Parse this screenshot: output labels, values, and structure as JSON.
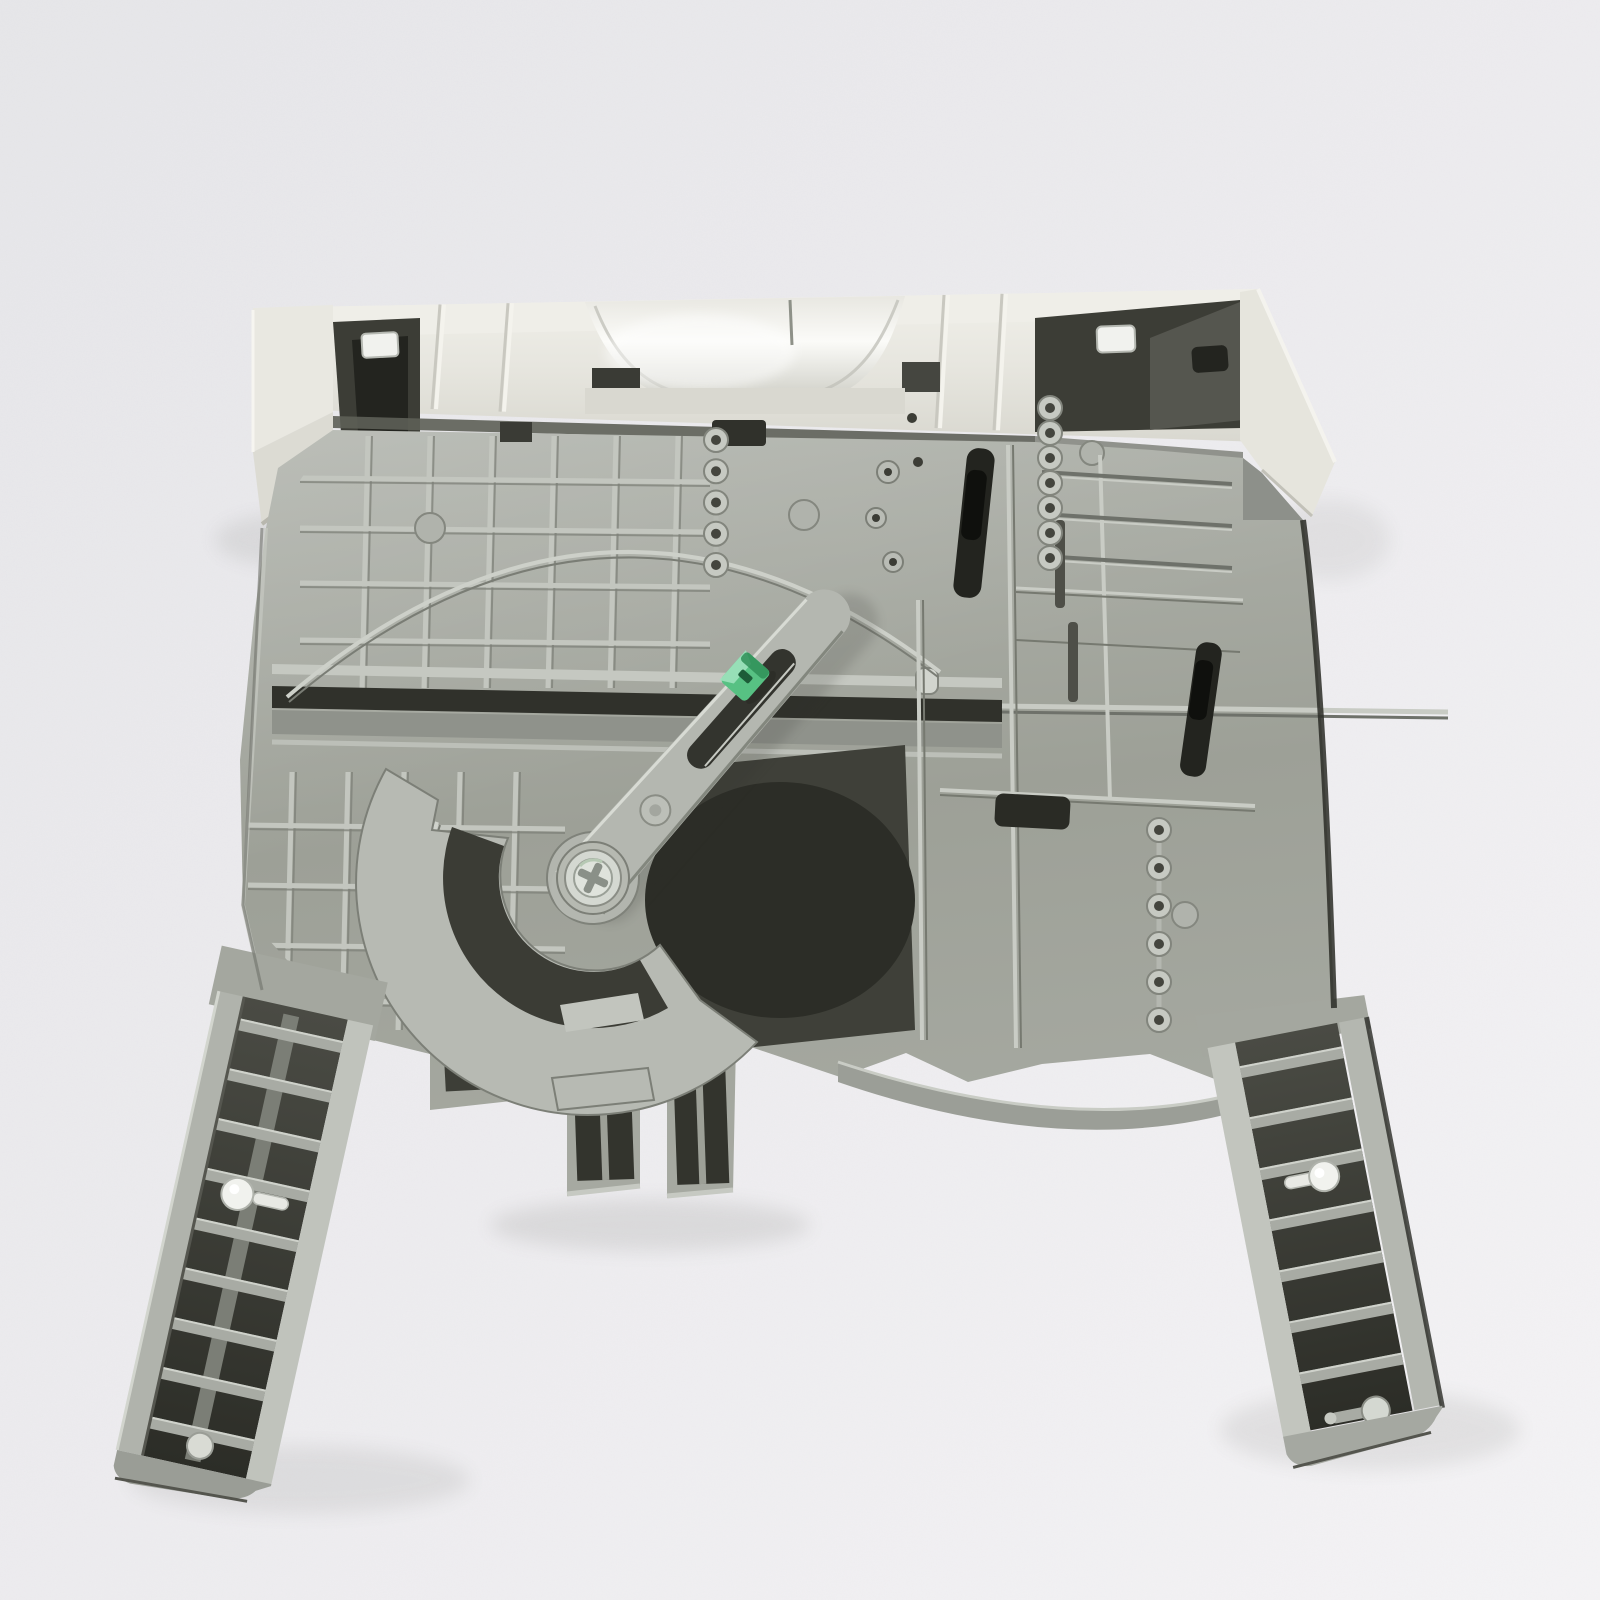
{
  "meta": {
    "type": "product photograph",
    "subject": "Printer paper cassette tray shown from the underside, tilted with its ivory front bezel at top and two telescoping slide rails extending toward the viewer",
    "background": "plain light-gray textured paper backdrop",
    "visible_text": ""
  },
  "colors": {
    "background": "#ebeaed",
    "background_bright": "#f4f3f5",
    "tray_gray": "#a6a9a1",
    "tray_gray_light": "#c3c6bf",
    "tray_gray_dark": "#7e8179",
    "panel_shadow": "#8f928b",
    "cavity_dark": "#3c3d36",
    "cavity_black": "#23241f",
    "bezel_ivory": "#e9e8e1",
    "bezel_ivory_light": "#f4f3ed",
    "bezel_ivory_shadow": "#c9c8c0",
    "green_clip": "#57c183",
    "green_clip_dark": "#2f8f58",
    "green_clip_light": "#9fe2bd",
    "roller_white": "#f1f2ee",
    "metal_silver": "#d4d8d1",
    "edge_dark": "#2a2b26"
  },
  "parts": {
    "tray": "printer paper tray underside",
    "bezel": "ivory front bezel with recessed handle scoop",
    "handle_scoop": "curved hand recess in bezel",
    "left_rail": "left slide rail with ladder ribs and white roller",
    "right_rail": "right slide rail with ladder ribs, white roller and metal pin",
    "cam": "rotating paper-length cam sector",
    "arm": "slotted adjustment swing arm",
    "green_clip": "green adjustment clip on arm slot",
    "screw": "silver pivot screw at cam center",
    "channel": "long dark guide channel across tray",
    "arc_guide": "thin arc-shaped guide ridge",
    "donut_chains": "rows of small ring-shaped bosses",
    "boxes": "open rib boxes along bottom edge",
    "latches": "small white latch tabs in dark bezel cavities"
  },
  "decor": {
    "donut_chains": [
      {
        "x": 716,
        "y1": 440,
        "y2": 565,
        "count": 5
      },
      {
        "x": 685,
        "y1": 837,
        "y2": 1005,
        "count": 6
      },
      {
        "x": 1050,
        "y1": 408,
        "y2": 558,
        "count": 7
      },
      {
        "x": 1159,
        "y1": 830,
        "y2": 1020,
        "count": 6
      }
    ],
    "left_rail": {
      "count": 9,
      "x": -52,
      "width": 106,
      "y0": 22,
      "dy": 51,
      "h": 12
    },
    "right_rail": {
      "count": 7,
      "x": -56,
      "width": 104,
      "y0": 24,
      "dy": 52,
      "h": 12
    },
    "grid_upper": {
      "verticals": [
        368,
        430,
        492,
        554,
        616,
        678
      ],
      "horizontals": [
        478,
        528,
        583,
        640
      ],
      "x1": 300,
      "x2": 710,
      "y1": 436,
      "y2": 688
    },
    "grid_lower": {
      "verticals": [
        292,
        348,
        404,
        460,
        516
      ],
      "horizontals": [
        825,
        885,
        945,
        1000
      ],
      "x1": 248,
      "x2": 565,
      "y1": 772,
      "y2": 1030
    },
    "bezel_ribs": [
      440,
      508,
      944,
      1002
    ],
    "right_plate_grooves": [
      472,
      514,
      556
    ]
  }
}
